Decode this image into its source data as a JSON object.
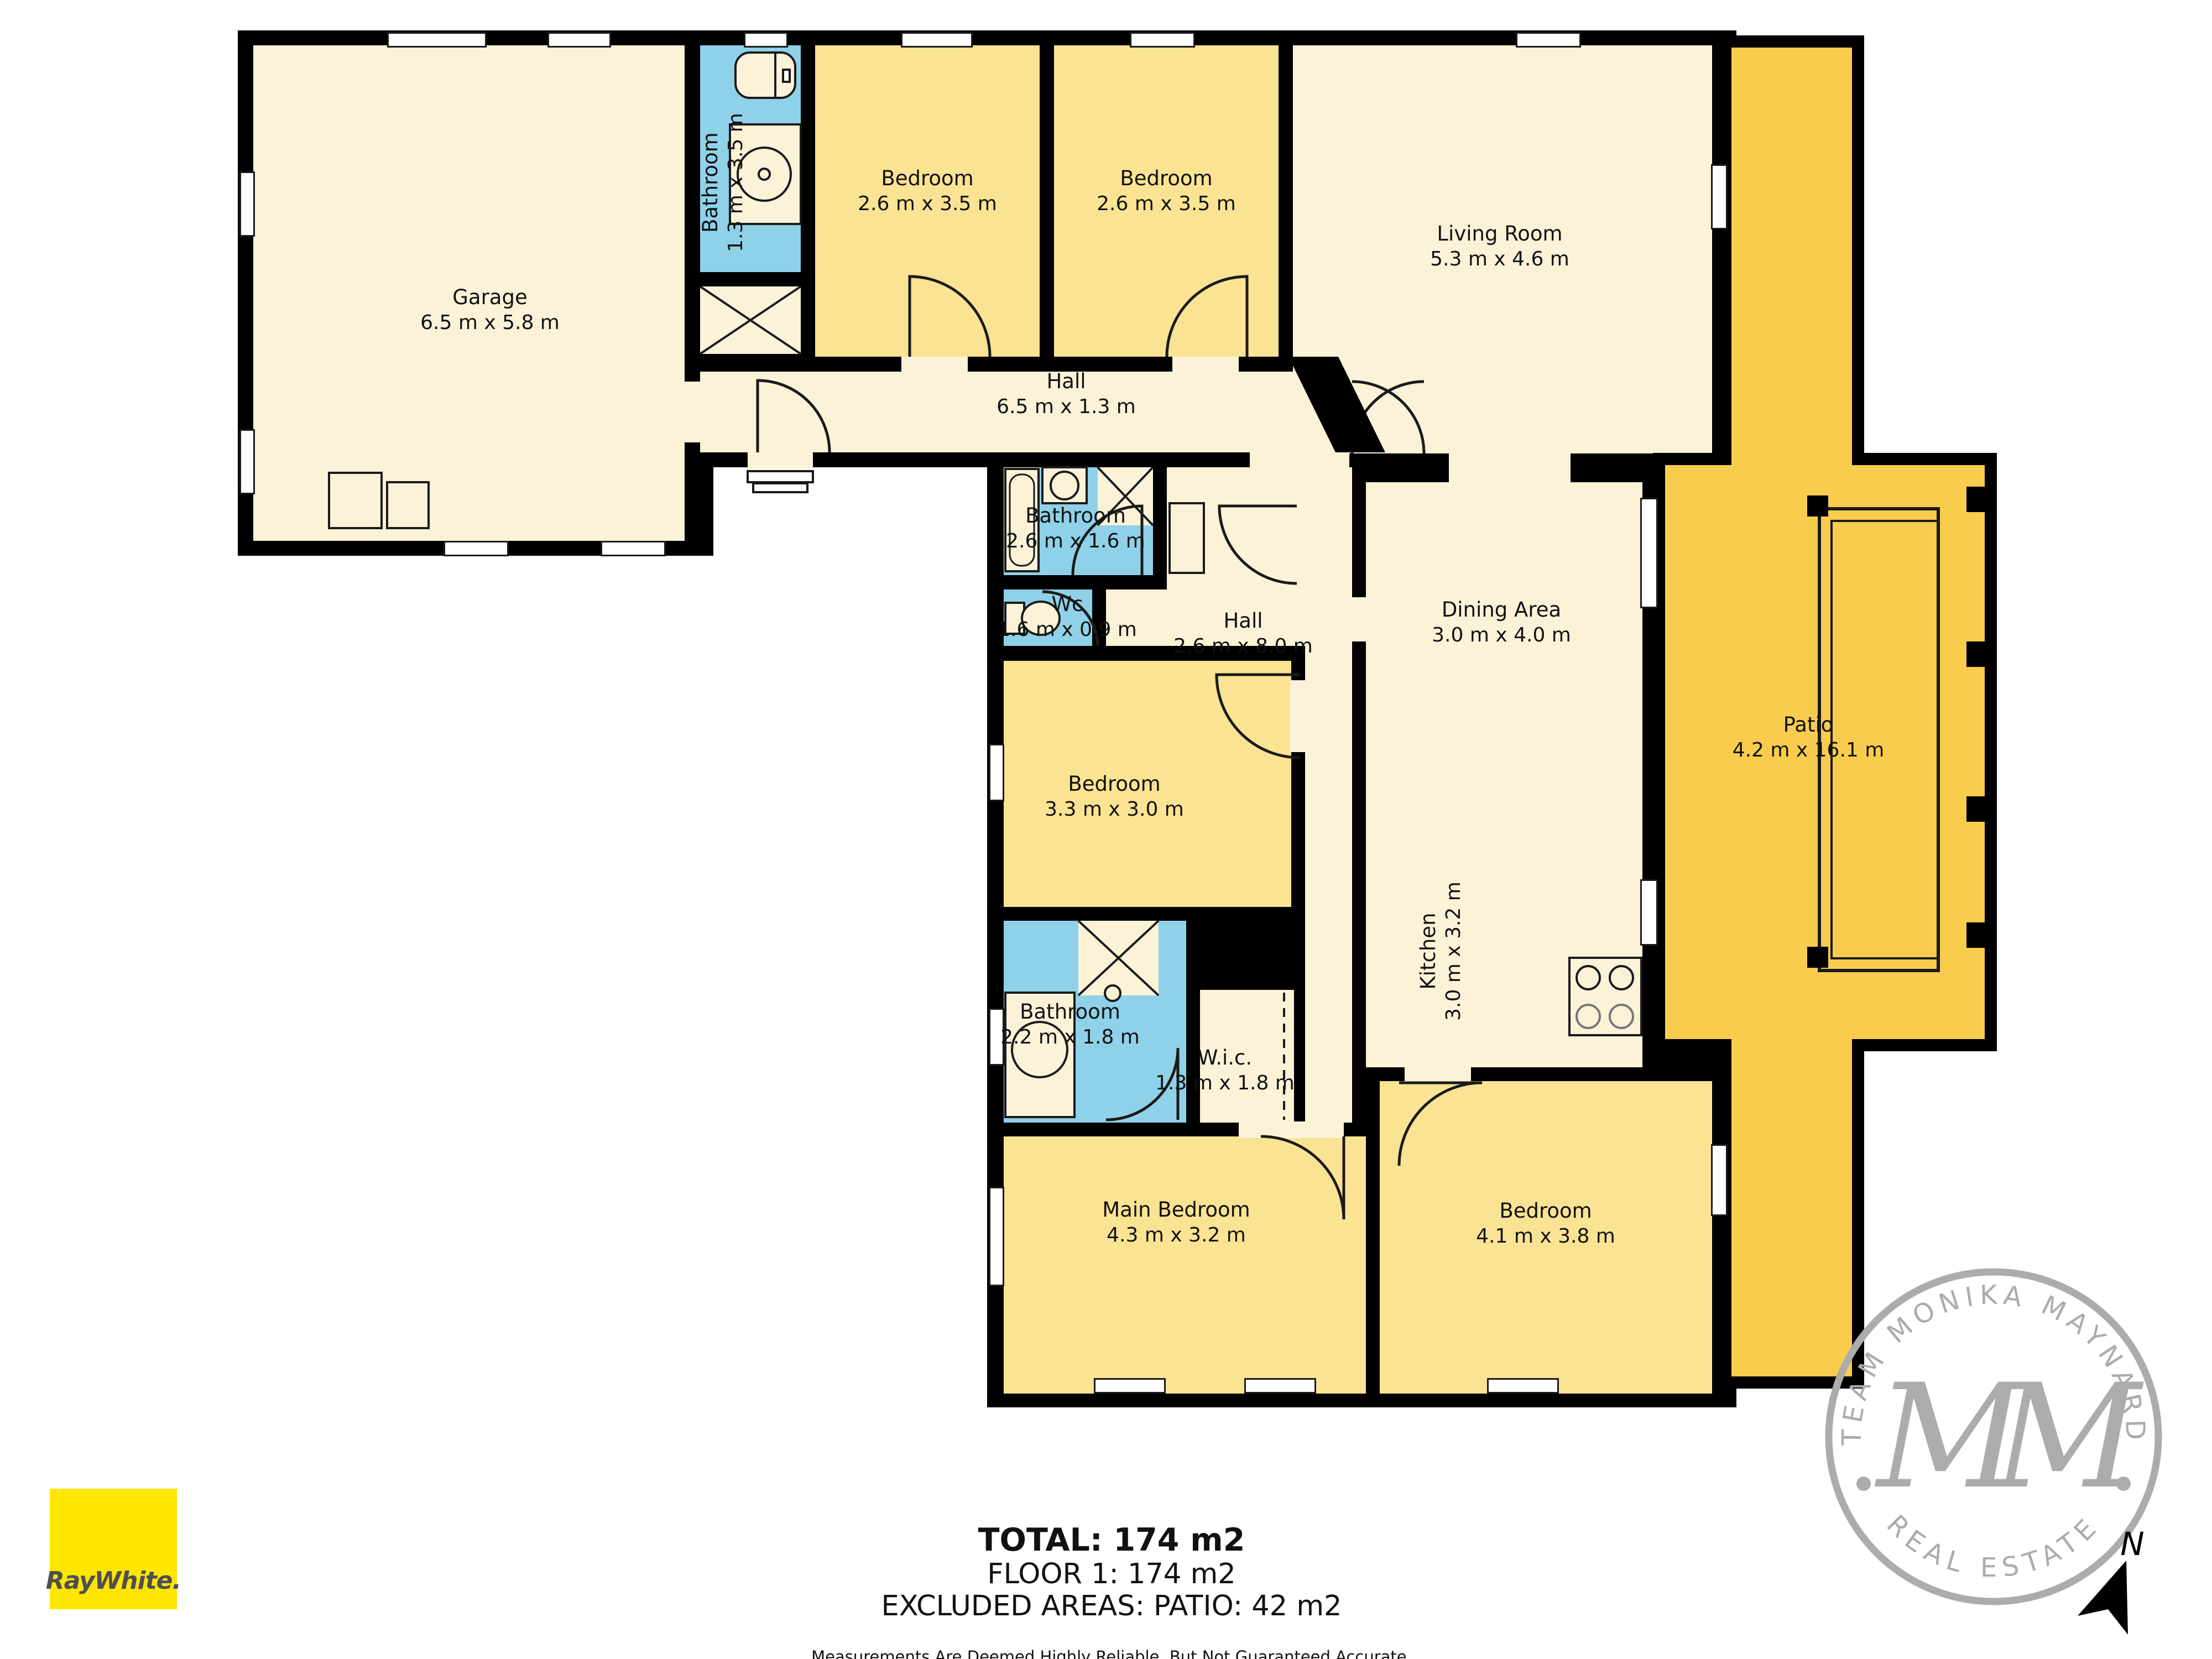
{
  "plan": {
    "rooms": {
      "garage": {
        "name": "Garage",
        "dims": "6.5 m x 5.8 m"
      },
      "bathroom_top": {
        "name": "Bathroom",
        "dims": "1.3 m x 3.5 m"
      },
      "bedroom_top_left": {
        "name": "Bedroom",
        "dims": "2.6 m x 3.5 m"
      },
      "bedroom_top_right": {
        "name": "Bedroom",
        "dims": "2.6 m x 3.5 m"
      },
      "living_room": {
        "name": "Living Room",
        "dims": "5.3 m x 4.6 m"
      },
      "hall_top": {
        "name": "Hall",
        "dims": "6.5 m x 1.3 m"
      },
      "bathroom_mid": {
        "name": "Bathroom",
        "dims": "2.6 m x 1.6 m"
      },
      "wc": {
        "name": "Wc",
        "dims": "1.6 m x 0.9 m"
      },
      "hall_mid": {
        "name": "Hall",
        "dims": "2.6 m x 8.0 m"
      },
      "dining_area": {
        "name": "Dining Area",
        "dims": "3.0 m x 4.0 m"
      },
      "kitchen": {
        "name": "Kitchen",
        "dims": "3.0 m x 3.2 m"
      },
      "bedroom_mid": {
        "name": "Bedroom",
        "dims": "3.3 m x 3.0 m"
      },
      "patio": {
        "name": "Patio",
        "dims": "4.2 m x 16.1 m"
      },
      "bathroom_low": {
        "name": "Bathroom",
        "dims": "2.2 m x 1.8 m"
      },
      "wic": {
        "name": "W.i.c.",
        "dims": "1.3 m x 1.8 m"
      },
      "main_bedroom": {
        "name": "Main Bedroom",
        "dims": "4.3 m x 3.2 m"
      },
      "bedroom_bottom": {
        "name": "Bedroom",
        "dims": "4.1 m x 3.8 m"
      }
    },
    "summary": {
      "total": "TOTAL: 174 m2",
      "floor": "FLOOR 1: 174 m2",
      "excluded": "EXCLUDED AREAS: PATIO: 42 m2",
      "disclaimer": "Measurements Are Deemed Highly Reliable, But Not Guaranteed Accurate."
    },
    "compass": {
      "label": "N"
    }
  },
  "branding": {
    "agency": {
      "logo_text": "RayWhite.",
      "brand_color": "#FFE600"
    },
    "stamp": {
      "arc_top": "TEAM MONIKA MAYNARD",
      "arc_bottom": "REAL ESTATE",
      "monogram": "MM",
      "color": "#ACACAC"
    }
  },
  "colors": {
    "room_light": "#FBF2D8",
    "room_yellow": "#FAE392",
    "room_blue": "#8FD1E9",
    "patio_gold": "#FACC4E",
    "walls": "#000000"
  }
}
